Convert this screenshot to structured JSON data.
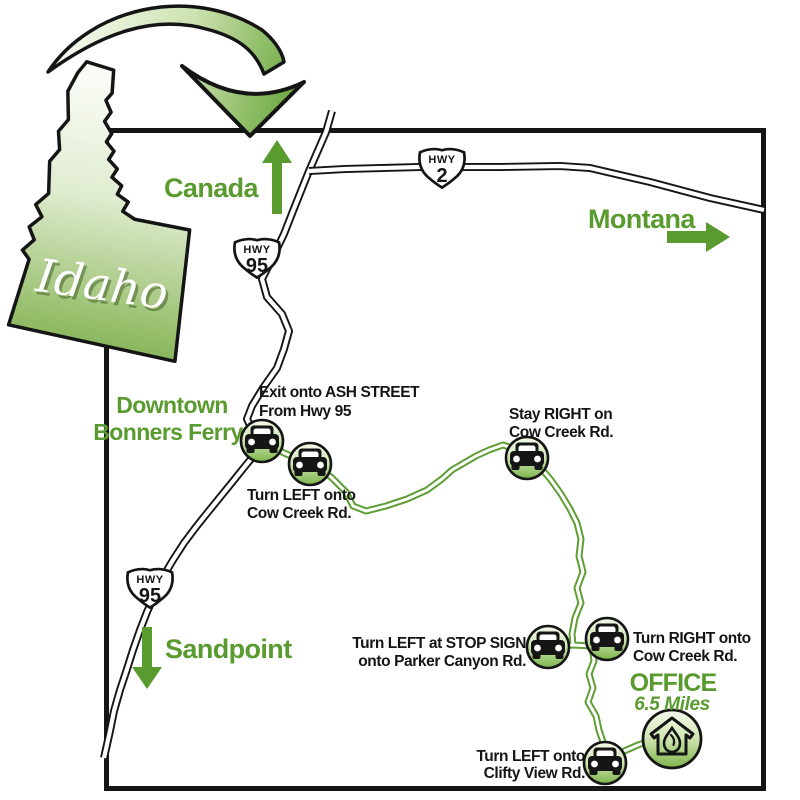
{
  "inset": {
    "state_label": "Idaho"
  },
  "regions": {
    "canada": "Canada",
    "montana": "Montana",
    "sandpoint": "Sandpoint"
  },
  "city": {
    "line1": "Downtown",
    "line2": "Bonners Ferry"
  },
  "shields": {
    "hwy95_north": {
      "prefix": "HWY",
      "number": "95"
    },
    "hwy2": {
      "prefix": "HWY",
      "number": "2"
    },
    "hwy95_south": {
      "prefix": "HWY",
      "number": "95"
    }
  },
  "directions": [
    {
      "line1": "Exit onto ASH STREET",
      "line2": "From Hwy 95"
    },
    {
      "line1": "Turn LEFT onto",
      "line2": "Cow Creek Rd."
    },
    {
      "line1": "Stay RIGHT on",
      "line2": "Cow Creek Rd."
    },
    {
      "line1": "Turn LEFT at STOP SIGN",
      "line2": "onto Parker Canyon Rd."
    },
    {
      "line1": "Turn RIGHT onto",
      "line2": "Cow Creek Rd."
    },
    {
      "line1": "Turn LEFT onto",
      "line2": "Clifty View Rd."
    }
  ],
  "destination": {
    "label": "OFFICE",
    "distance": "6.5 Miles"
  },
  "icons": {
    "route_stop": "car-icon",
    "destination": "house-drop-icon",
    "inset_pointer": "curved-arrow-icon",
    "canada_direction": "arrow-up-icon",
    "montana_direction": "arrow-right-icon",
    "sandpoint_direction": "arrow-down-icon"
  },
  "colors": {
    "label_green": "#5a9b2f",
    "route_green": "#5f9e35",
    "road_black": "#151515",
    "state_green": "#68a341",
    "background": "#ffffff"
  }
}
